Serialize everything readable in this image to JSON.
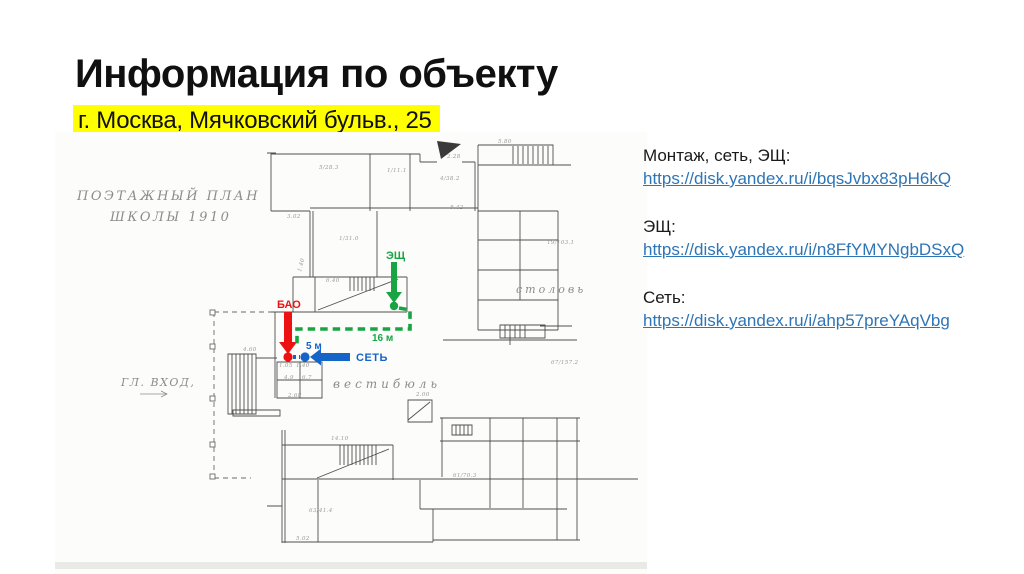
{
  "slide": {
    "title": "Информация по объекту",
    "subtitle": "г. Москва, Мячковский бульв., 25",
    "highlight_color": "#ffff00"
  },
  "links_panel": {
    "link_color": "#2e75b6",
    "groups": [
      {
        "label": "Монтаж, сеть, ЭЩ:",
        "url": "https://disk.yandex.ru/i/bqsJvbx83pH6kQ"
      },
      {
        "label": "ЭЩ:",
        "url": "https://disk.yandex.ru/i/n8FfYMYNgbDSxQ"
      },
      {
        "label": "Сеть:",
        "url": "https://disk.yandex.ru/i/ahp57preYAqVbg"
      }
    ]
  },
  "floor_plan": {
    "annotations": {
      "bao": {
        "label": "БАО",
        "color": "#ee1111"
      },
      "shield": {
        "label": "ЭЩ",
        "distance": "16 м",
        "color": "#17a544"
      },
      "network": {
        "label": "СЕТЬ",
        "distance": "5 м",
        "color": "#1565c9"
      }
    },
    "hand_labels": [
      {
        "text": "ПОЭТАЖНЫЙ ПЛАН",
        "x": 22,
        "y": 68,
        "size": 13,
        "ls": 2.5
      },
      {
        "text": "ШКОЛЫ 1910",
        "x": 55,
        "y": 89,
        "size": 13,
        "ls": 2.5
      },
      {
        "text": "ГЛ. ВХОД,",
        "x": 66,
        "y": 254,
        "size": 11,
        "ls": 1.5
      },
      {
        "text": "вестибюль",
        "x": 278,
        "y": 256,
        "size": 12,
        "ls": 4
      },
      {
        "text": "столовь",
        "x": 461,
        "y": 161,
        "size": 11,
        "ls": 3
      }
    ],
    "dimension_marks": [
      {
        "x": 443,
        "y": 11,
        "text": "5.80"
      },
      {
        "x": 392,
        "y": 26,
        "text": "2.28"
      },
      {
        "x": 385,
        "y": 48,
        "text": "4/38.2"
      },
      {
        "x": 395,
        "y": 77,
        "text": "8.42"
      },
      {
        "x": 264,
        "y": 37,
        "text": "5/28.3"
      },
      {
        "x": 332,
        "y": 40,
        "text": "1/11.1"
      },
      {
        "x": 232,
        "y": 86,
        "text": "3.02"
      },
      {
        "x": 284,
        "y": 108,
        "text": "1/31.0"
      },
      {
        "x": 271,
        "y": 150,
        "text": "6.40"
      },
      {
        "x": 246,
        "y": 140,
        "text": "1.40",
        "rot": -75
      },
      {
        "x": 188,
        "y": 219,
        "text": "4.60"
      },
      {
        "x": 233,
        "y": 265,
        "text": "2.68"
      },
      {
        "x": 361,
        "y": 264,
        "text": "2.00"
      },
      {
        "x": 276,
        "y": 308,
        "text": "14.10"
      },
      {
        "x": 492,
        "y": 112,
        "text": "19/103.1"
      },
      {
        "x": 496,
        "y": 232,
        "text": "67/157.2"
      },
      {
        "x": 254,
        "y": 380,
        "text": "63/41.4"
      },
      {
        "x": 398,
        "y": 345,
        "text": "61/70.3"
      },
      {
        "x": 241,
        "y": 408,
        "text": "5.02"
      },
      {
        "x": 224,
        "y": 235,
        "text": "1.05"
      },
      {
        "x": 241,
        "y": 235,
        "text": "1.40"
      },
      {
        "x": 229,
        "y": 247,
        "text": "4.9"
      },
      {
        "x": 247,
        "y": 247,
        "text": "6.7"
      }
    ]
  }
}
